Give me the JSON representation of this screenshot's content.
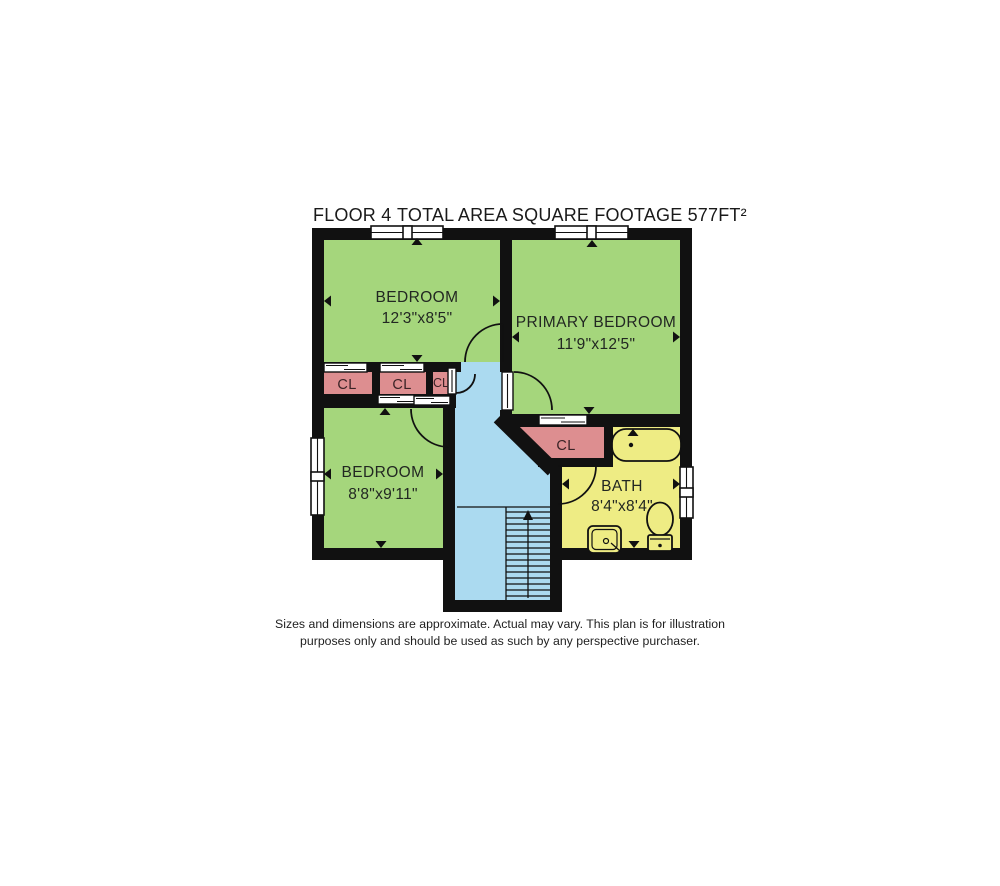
{
  "header": {
    "floor_label": "FLOOR 4",
    "area_label": "TOTAL AREA SQUARE FOOTAGE 577FT²"
  },
  "rooms": {
    "bedroom_top": {
      "name": "BEDROOM",
      "dims": "12'3\"x8'5\""
    },
    "primary_bedroom": {
      "name": "PRIMARY BEDROOM",
      "dims": "11'9\"x12'5\""
    },
    "bedroom_bottom": {
      "name": "BEDROOM",
      "dims": "8'8\"x9'11\""
    },
    "bath": {
      "name": "BATH",
      "dims": "8'4\"x8'4\""
    },
    "closet_1": {
      "name": "CL"
    },
    "closet_2": {
      "name": "CL"
    },
    "closet_3": {
      "name": "CL"
    },
    "closet_bath": {
      "name": "CL"
    }
  },
  "footer": {
    "disclaimer_line1": "Sizes and dimensions are approximate. Actual may vary. This plan is for illustration",
    "disclaimer_line2": "purposes only and should be used as such by any perspective purchaser."
  },
  "colors": {
    "wall": "#111111",
    "bedroom_fill": "#a5d67c",
    "closet_fill": "#dd8e90",
    "bath_fill": "#eeec84",
    "stairs_fill": "#abdaf0",
    "background": "#ffffff",
    "text": "#222222"
  }
}
